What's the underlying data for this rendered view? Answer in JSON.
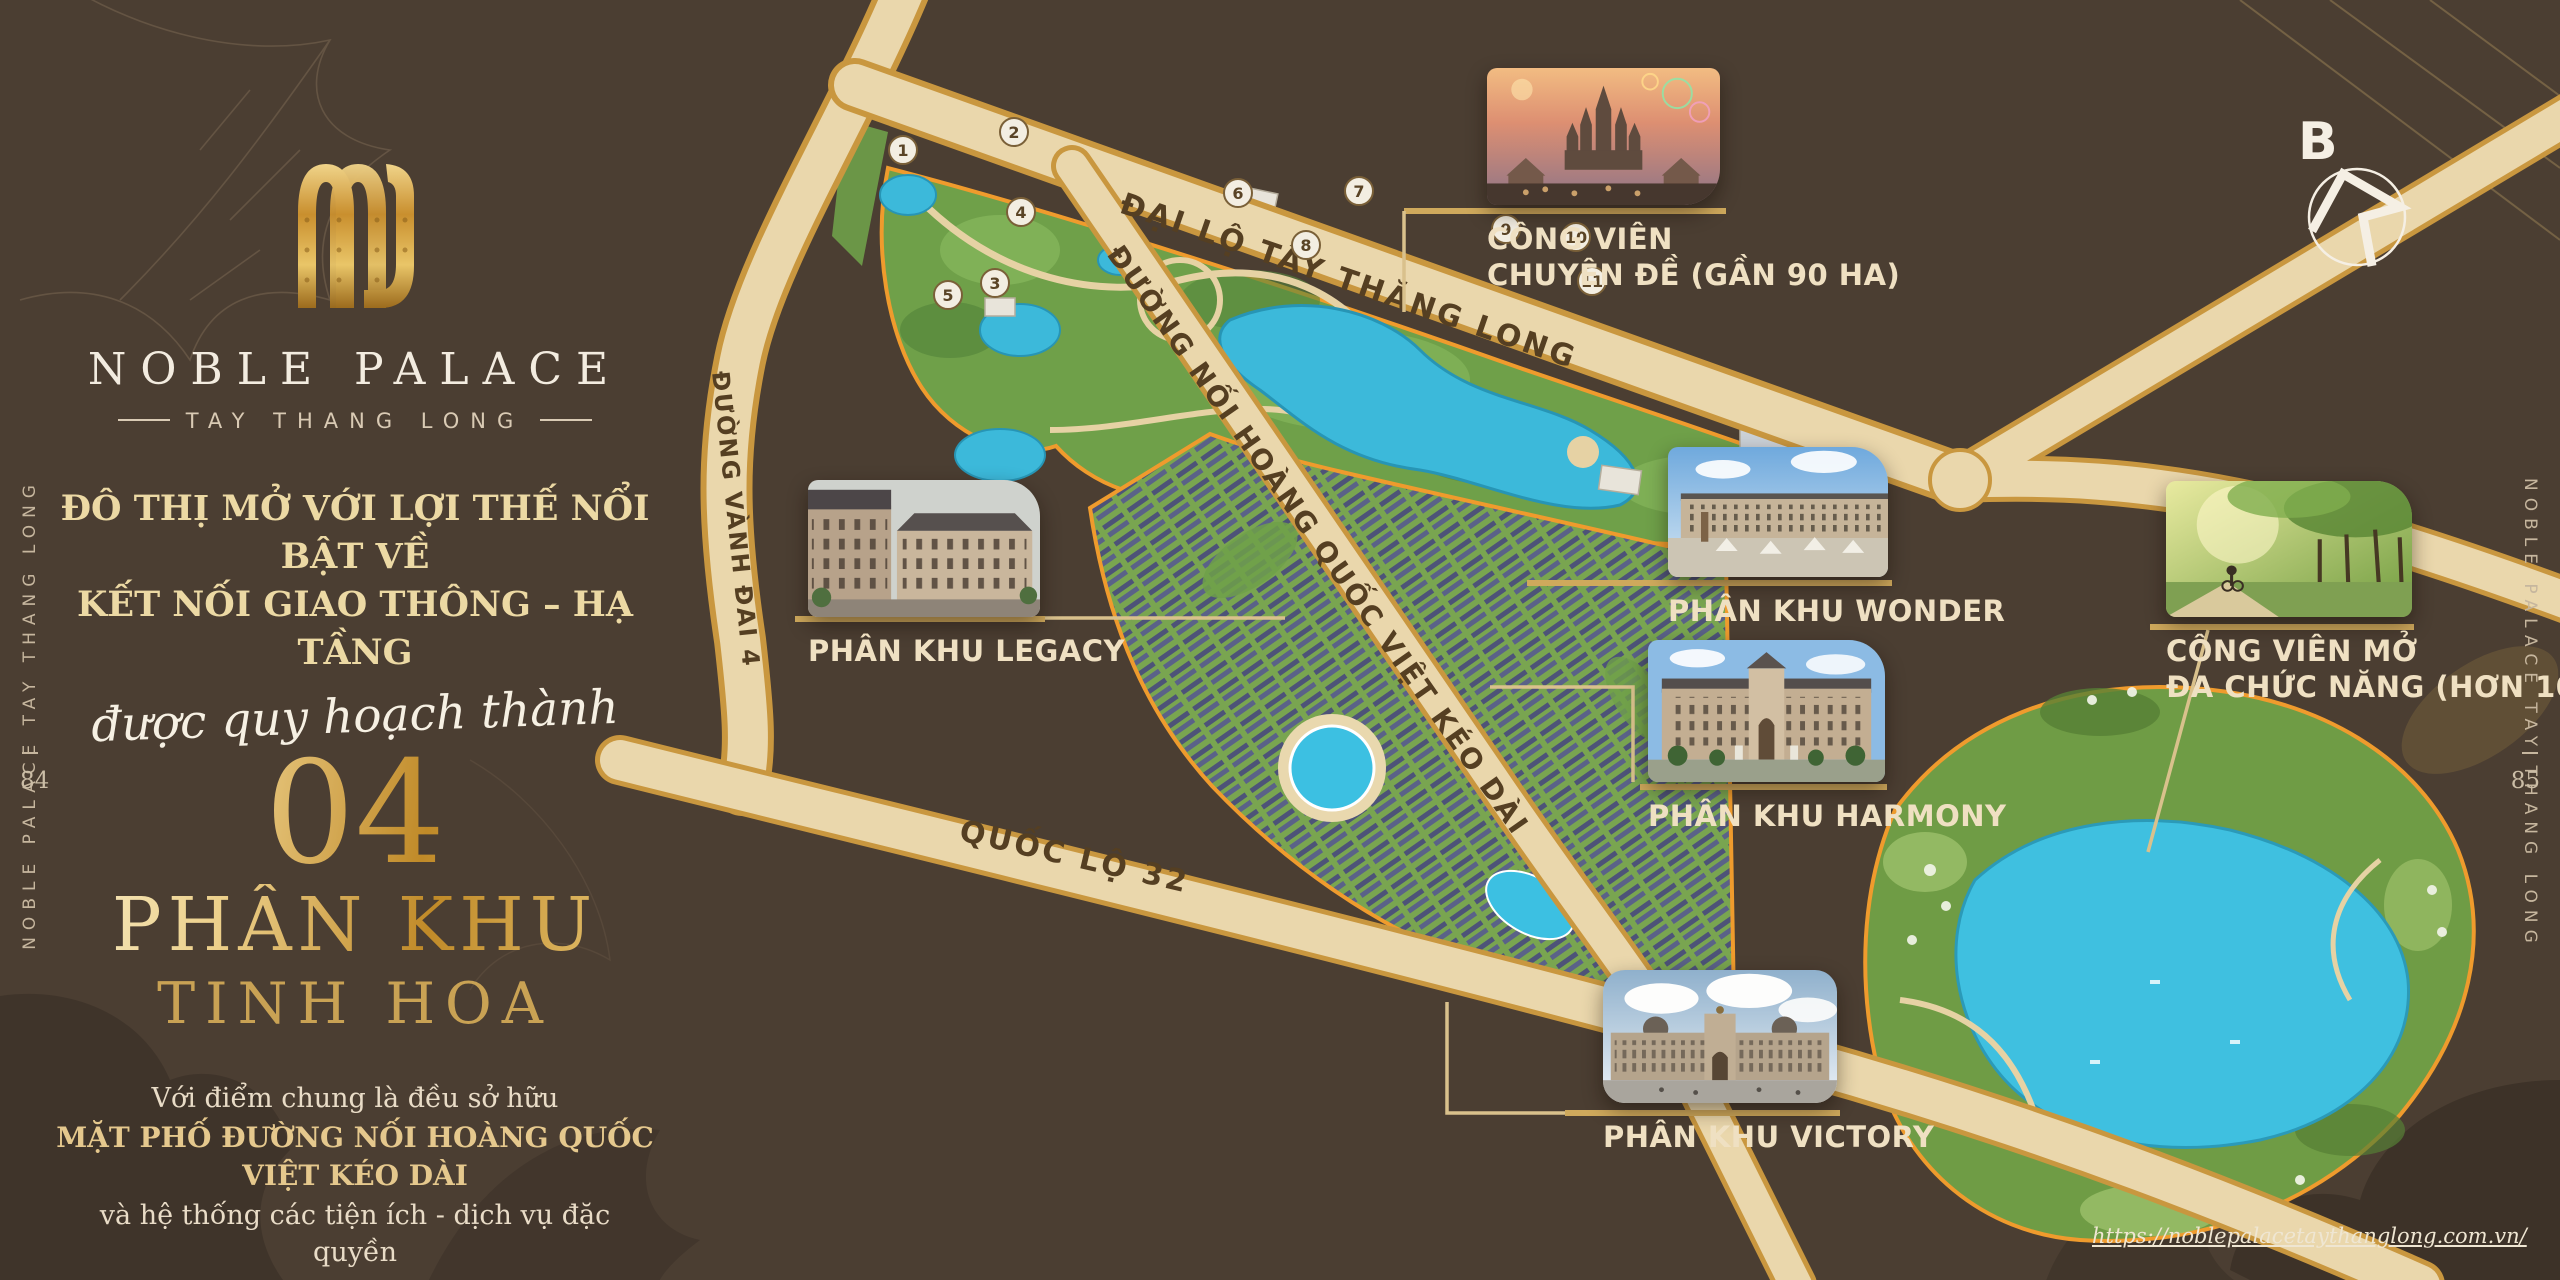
{
  "page": {
    "left_page_number": "84",
    "right_page_number": "85",
    "side_rail_text": "NOBLE PALACE TAY THANG LONG",
    "website": "https://noblepalacetaythanglong.com.vn/"
  },
  "brand": {
    "name": "NOBLE PALACE",
    "tagline": "TAY THANG LONG"
  },
  "intro": {
    "heading_line1": "ĐÔ THỊ MỞ VỚI LỢI THẾ NỔI BẬT VỀ",
    "heading_line2": "KẾT NỐI GIAO THÔNG – HẠ TẦNG",
    "script_line": "được quy hoạch thành",
    "big_number": "04",
    "subheading_line1": "PHÂN KHU",
    "subheading_line2": "TINH HOA",
    "body_line1": "Với điểm chung là đều sở hữu",
    "body_line2": "MẶT PHỐ ĐƯỜNG NỐI HOÀNG QUỐC VIỆT KÉO DÀI",
    "body_line3": "và hệ thống các tiện ích - dịch vụ đặc quyền"
  },
  "compass": {
    "label": "B"
  },
  "map": {
    "road_labels": [
      "ĐẠI LỘ TÂY THĂNG LONG",
      "ĐƯỜNG VÀNH ĐAI 4",
      "QUỐC LỘ 32",
      "ĐƯỜNG NỐI HOÀNG QUỐC VIỆT KÉO DÀI"
    ],
    "markers": [
      "1",
      "2",
      "3",
      "4",
      "5",
      "6",
      "7",
      "8",
      "9",
      "10",
      "11"
    ]
  },
  "callouts": [
    {
      "id": "theme-park",
      "lines": [
        "CÔNG VIÊN",
        "CHUYÊN ĐỀ (GẦN 90 HA)"
      ]
    },
    {
      "id": "legacy",
      "lines": [
        "PHÂN KHU LEGACY"
      ]
    },
    {
      "id": "wonder",
      "lines": [
        "PHÂN KHU WONDER"
      ]
    },
    {
      "id": "harmony",
      "lines": [
        "PHÂN KHU HARMONY"
      ]
    },
    {
      "id": "open-park",
      "lines": [
        "CÔNG VIÊN MỞ",
        "ĐA CHỨC NĂNG (HƠN 100 HA)"
      ]
    },
    {
      "id": "victory",
      "lines": [
        "PHÂN KHU VICTORY"
      ]
    }
  ],
  "colors": {
    "background": "#4b3e32",
    "gold_accent": "#c9a254",
    "heading_gold": "#ecd9a4",
    "map_outline_orange": "#ef9b2d",
    "water": "#3cc0e2",
    "road_fill": "#ead7ac",
    "label_cream": "#efe0c2"
  }
}
